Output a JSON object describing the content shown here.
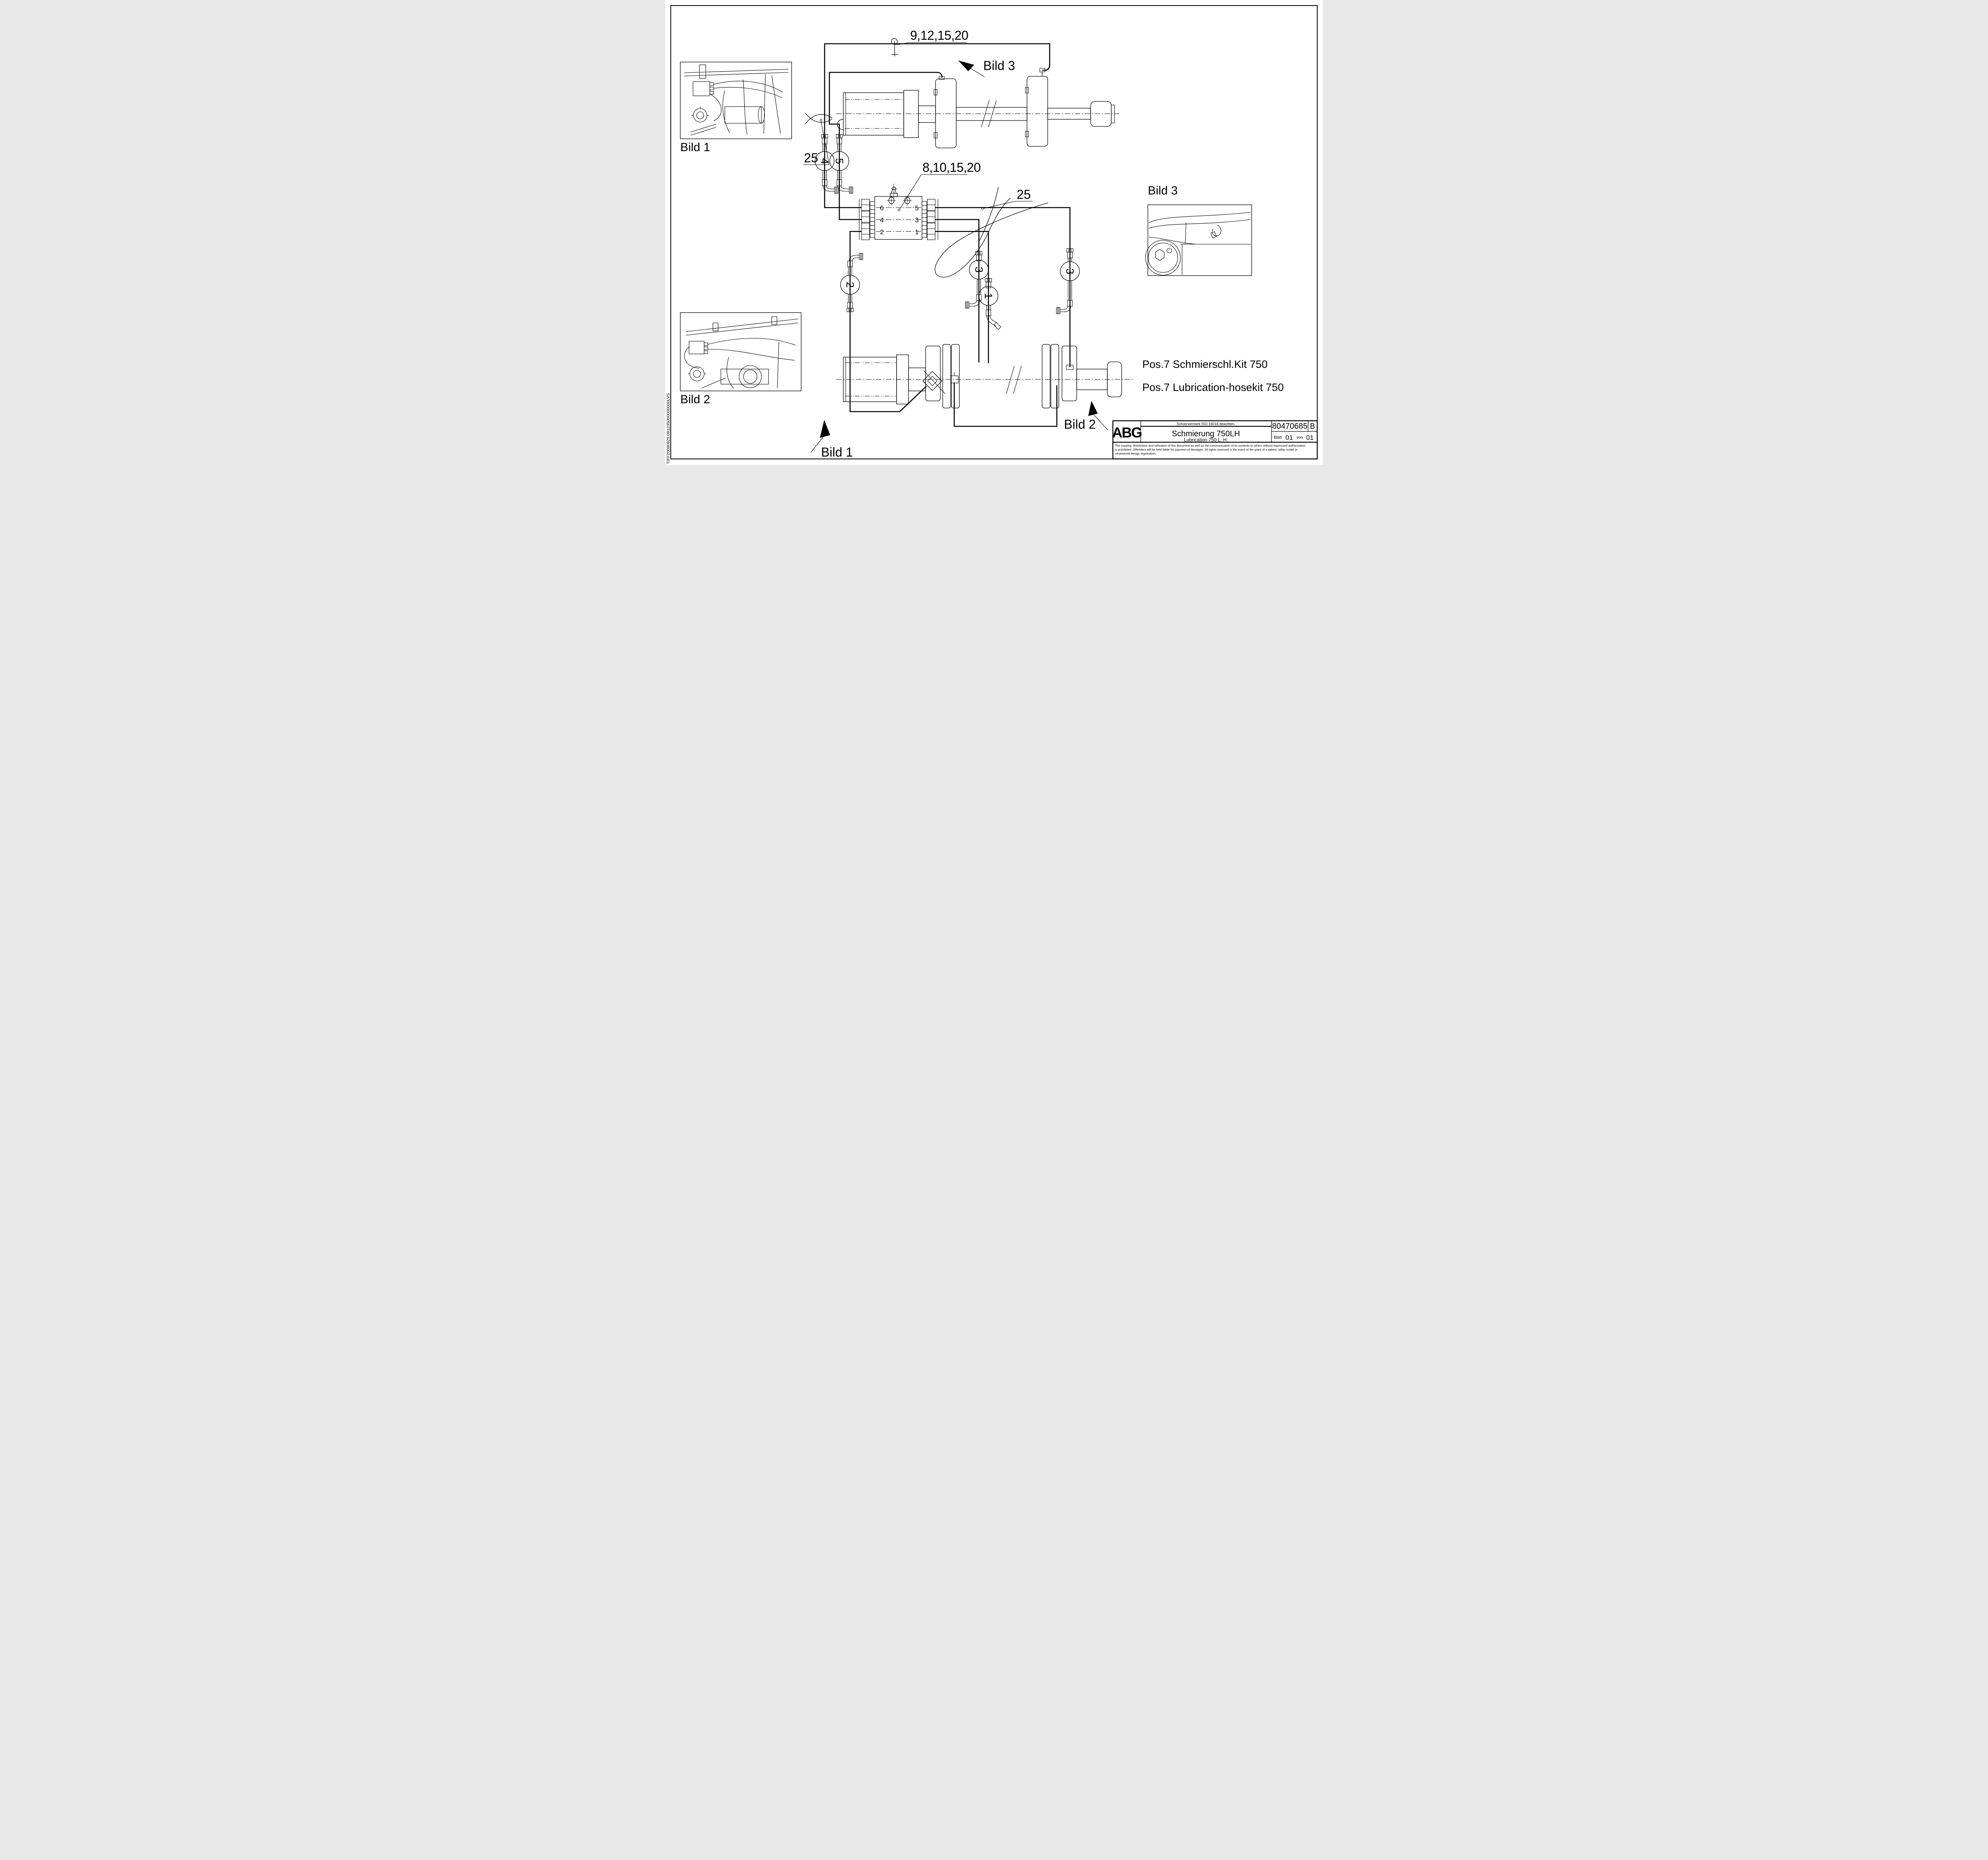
{
  "page": {
    "side_code": "TIFF20080925.081235000000000LVS"
  },
  "labels": {
    "top_parts": "9,12,15,20",
    "mid_parts": "8,10,15,20",
    "coil_left": "25",
    "coil_mid": "25",
    "bild1_caption": "Bild 1",
    "bild2_caption": "Bild 2",
    "bild3_caption": "Bild 3",
    "bild1_ref": "Bild 1",
    "bild2_ref": "Bild 2",
    "bild3_ref": "Bild 3",
    "pos_line1": "Pos.7 Schmierschl.Kit 750",
    "pos_line2": "Pos.7 Lubrication-hosekit 750"
  },
  "valve_block": {
    "left_ports": [
      "6",
      "4",
      "2"
    ],
    "right_ports": [
      "5",
      "3",
      "1"
    ]
  },
  "callouts": {
    "hose4": "4",
    "hose5": "5",
    "hose2": "2",
    "hose3a": "3",
    "hose1": "1",
    "hose3b": "3"
  },
  "title_block": {
    "company": "ABG",
    "notice": "Schutzvermerk ISO 16016 beachten.",
    "title_de": "Schmierung 750LH",
    "title_en": "Lubrication 750 L. H.",
    "drawing_number": "80470685",
    "revision": "B",
    "sheet_label": "Blatt",
    "sheet_number": "01",
    "of_label": "von",
    "sheet_total": "01",
    "legal": [
      "The copying, distribution and utilization of this document as well as the communication of its contents to others without expressed authorization",
      "is prohibited. Offenders will be held liable for payment of damages. All rights reserved in the event of the grant of a patent, utility model or",
      "ornamental design registration."
    ]
  }
}
